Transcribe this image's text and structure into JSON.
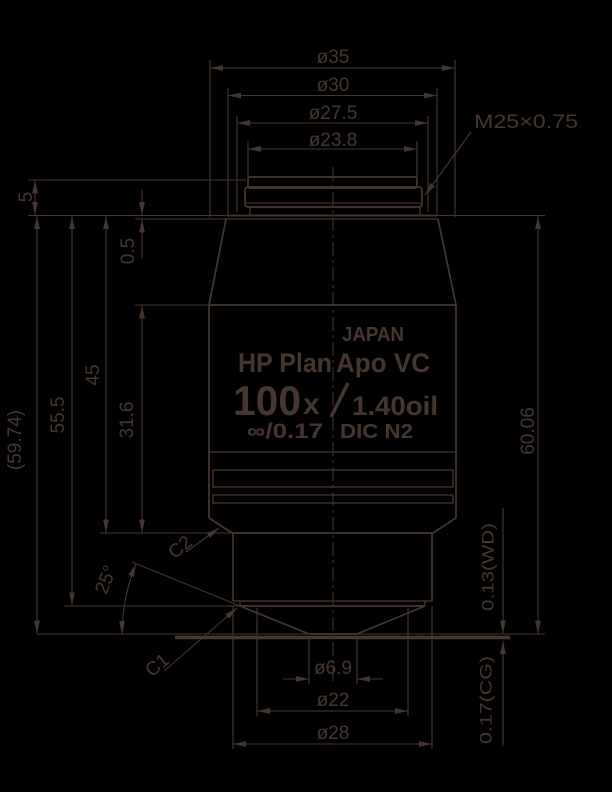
{
  "colors": {
    "background": "#000000",
    "ink": "#463630"
  },
  "dims": {
    "d35": "ø35",
    "d30": "ø30",
    "d27_5": "ø27.5",
    "d23_8": "ø23.8",
    "thread": "M25×0.75",
    "len5": "5",
    "len59_74": "(59.74)",
    "len55_5": "55.5",
    "len45": "45",
    "len0_5": "0.5",
    "len31_6": "31.6",
    "len60_06": "60.06",
    "wd": "0.13(WD)",
    "cg": "0.17(CG)",
    "d6_9": "ø6.9",
    "d22": "ø22",
    "d28": "ø28",
    "angle": "25°",
    "c1": "C1",
    "c2": "C2"
  },
  "label": {
    "country": "JAPAN",
    "series_left": "HP Plan",
    "series_right": "Apo VC",
    "magnification": "100",
    "mag_x": "x",
    "aperture": "1.40oil",
    "tube": "∞/0.17",
    "contrast": "DIC N2"
  }
}
